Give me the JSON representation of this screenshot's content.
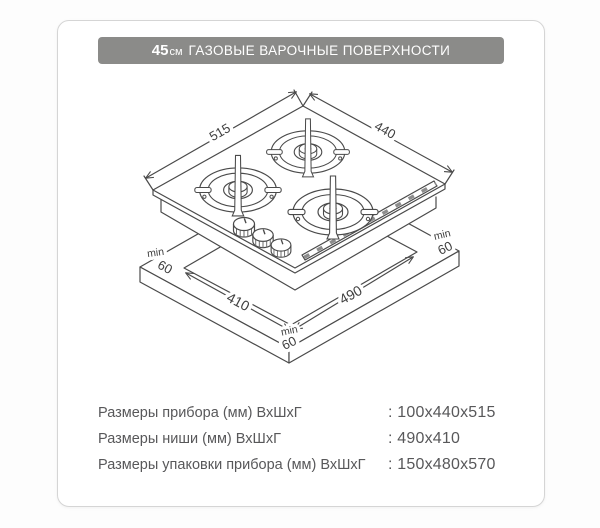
{
  "header": {
    "size": "45",
    "unit": "см",
    "title": "ГАЗОВЫЕ ВАРОЧНЫЕ ПОВЕРХНОСТИ"
  },
  "diagram": {
    "dim_left_edge": "515",
    "dim_right_edge": "440",
    "dim_cutout_left": "410",
    "dim_cutout_right": "490",
    "min": "min",
    "clearance": "60"
  },
  "specs": {
    "rows": [
      {
        "label": "Размеры прибора (мм) ВхШхГ",
        "value": ": 100x440x515"
      },
      {
        "label": "Размеры ниши (мм) ВхШхГ",
        "value": ": 490x410"
      },
      {
        "label": "Размеры упаковки прибора (мм) ВхШхГ",
        "value": ": 150x480x570"
      }
    ]
  },
  "colors": {
    "header_bg": "#8b8b89",
    "card_border": "#d5d5d5",
    "text": "#58585a",
    "line": "#4a4a4a"
  }
}
